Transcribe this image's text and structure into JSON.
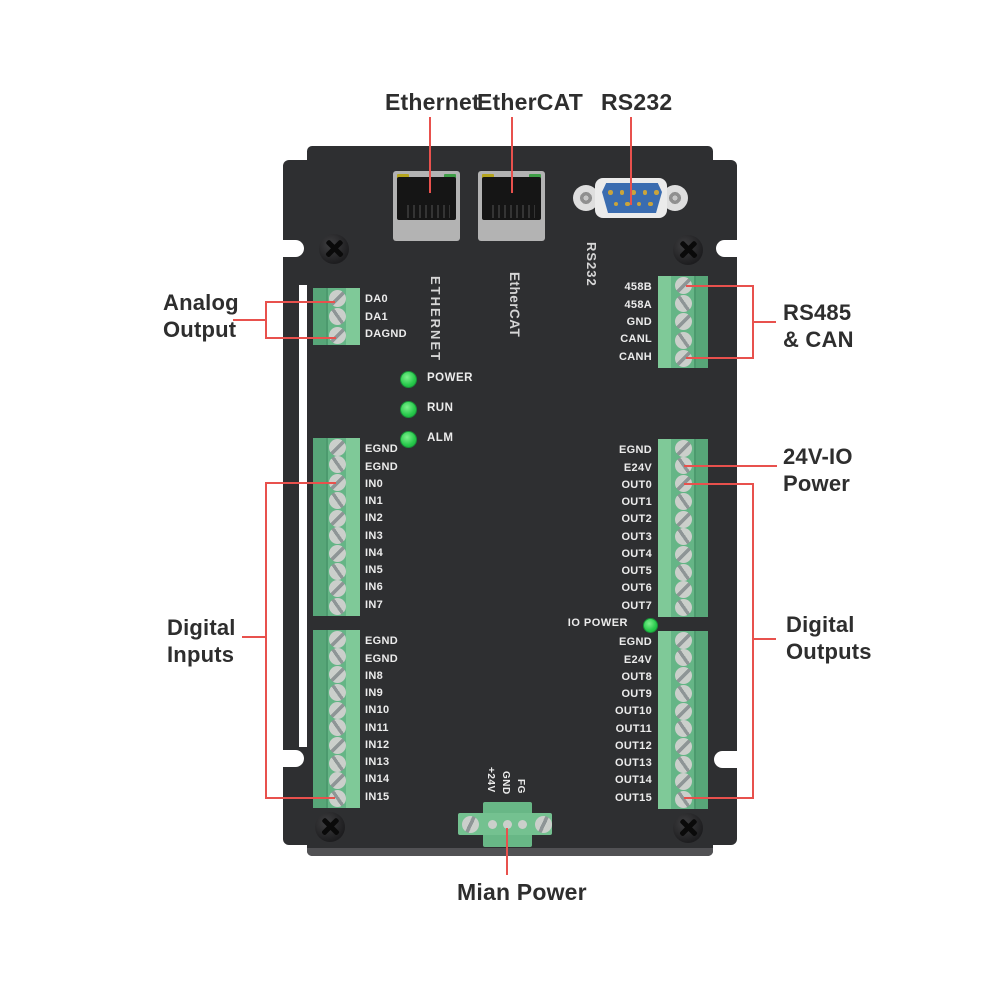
{
  "colors": {
    "body": "#2e2f31",
    "annotation_red": "#e8514d",
    "terminal_green": "#65b586",
    "led_green": "#27c94b",
    "db9_blue": "#3a6cb0"
  },
  "callouts": {
    "ethernet": "Ethernet",
    "ethercat": "EtherCAT",
    "rs232": "RS232",
    "analog_output": {
      "line1": "Analog",
      "line2": "Output"
    },
    "rs485_can": {
      "line1": "RS485",
      "line2": "& CAN"
    },
    "io_power_24v": {
      "line1": "24V-IO",
      "line2": "Power"
    },
    "digital_inputs": {
      "line1": "Digital",
      "line2": "Inputs"
    },
    "digital_outputs": {
      "line1": "Digital",
      "line2": "Outputs"
    },
    "main_power": "Mian Power"
  },
  "board": {
    "silkscreen": {
      "ethernet": "ETHERNET",
      "ethercat": "EtherCAT",
      "rs232": "RS232",
      "io_power": "IO POWER"
    },
    "status_leds": [
      {
        "label": "POWER"
      },
      {
        "label": "RUN"
      },
      {
        "label": "ALM"
      }
    ],
    "blocks": {
      "analog": {
        "labels": [
          "DA0",
          "DA1",
          "DAGND"
        ]
      },
      "rs485": {
        "labels": [
          "458B",
          "458A",
          "GND",
          "CANL",
          "CANH"
        ]
      },
      "inputs1": {
        "labels": [
          "EGND",
          "EGND",
          "IN0",
          "IN1",
          "IN2",
          "IN3",
          "IN4",
          "IN5",
          "IN6",
          "IN7"
        ]
      },
      "inputs2": {
        "labels": [
          "EGND",
          "EGND",
          "IN8",
          "IN9",
          "IN10",
          "IN11",
          "IN12",
          "IN13",
          "IN14",
          "IN15"
        ]
      },
      "outputs1": {
        "labels": [
          "EGND",
          "E24V",
          "OUT0",
          "OUT1",
          "OUT2",
          "OUT3",
          "OUT4",
          "OUT5",
          "OUT6",
          "OUT7"
        ]
      },
      "outputs2": {
        "labels": [
          "EGND",
          "E24V",
          "OUT8",
          "OUT9",
          "OUT10",
          "OUT11",
          "OUT12",
          "OUT13",
          "OUT14",
          "OUT15"
        ]
      },
      "power": {
        "labels": [
          "+24V",
          "GND",
          "FG"
        ]
      }
    }
  }
}
